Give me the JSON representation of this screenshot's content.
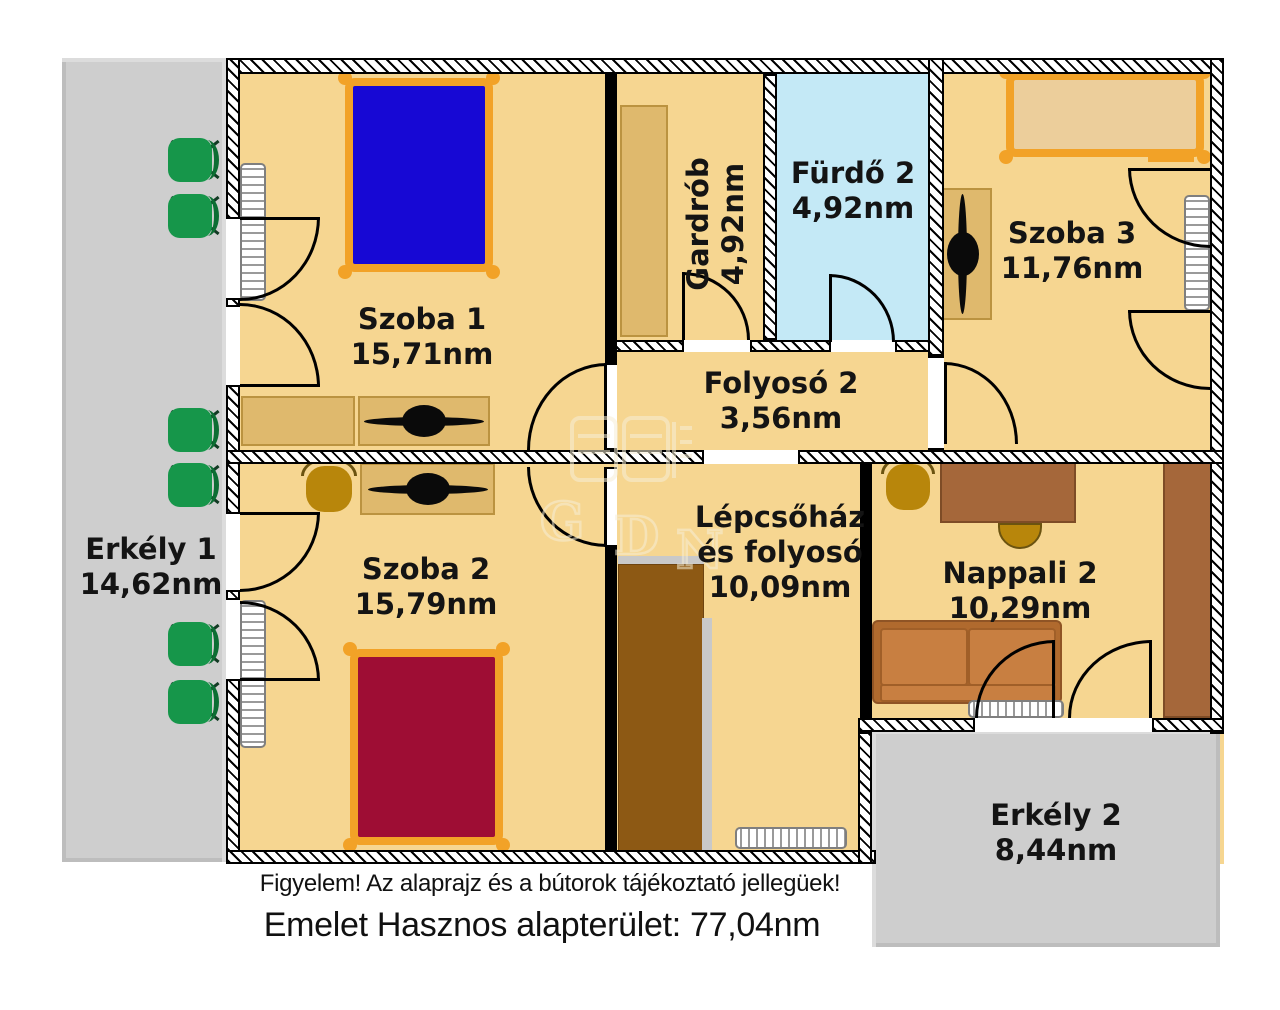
{
  "rooms": {
    "szoba1": {
      "name": "Szoba 1",
      "area": "15,71nm"
    },
    "szoba2": {
      "name": "Szoba 2",
      "area": "15,79nm"
    },
    "szoba3": {
      "name": "Szoba 3",
      "area": "11,76nm"
    },
    "gardrob": {
      "name": "Gardrób",
      "area": "4,92nm"
    },
    "furdo2": {
      "name": "Fürdő 2",
      "area": "4,92nm"
    },
    "folyoso2": {
      "name": "Folyosó 2",
      "area": "3,56nm"
    },
    "lepcsohaz": {
      "name_line1": "Lépcsőház",
      "name_line2": "és folyosó",
      "area": "10,09nm"
    },
    "nappali2": {
      "name": "Nappali 2",
      "area": "10,29nm"
    },
    "erkely1": {
      "name": "Erkély 1",
      "area": "14,62nm"
    },
    "erkely2": {
      "name": "Erkély 2",
      "area": "8,44nm"
    }
  },
  "footer": {
    "notice": "Figyelem! Az alaprajz és a bútorok tájékoztató jellegüek!",
    "total": "Emelet Hasznos alapterület: 77,04nm"
  },
  "watermark": {
    "letters": [
      "G",
      "D",
      "N"
    ]
  },
  "colors": {
    "floor": "#f6d691",
    "bath": "#c4e9f6",
    "balcony": "#cecece",
    "bed_blue": "#1708d4",
    "bed_red": "#9e0d34",
    "bed_tan": "#ecce9b",
    "orange": "#f2a227",
    "tan": "#dfb96d",
    "tan_border": "#bb9340",
    "stairs": "#8d5914",
    "wood": "#a5673a",
    "sofa_light": "#c87f41",
    "sofa_dark": "#b06a2e",
    "gold": "#b8860b",
    "green": "#16964a",
    "green_dark": "#0c6e33",
    "rail": "#c9c9c9",
    "wm": "#f6eed6"
  }
}
